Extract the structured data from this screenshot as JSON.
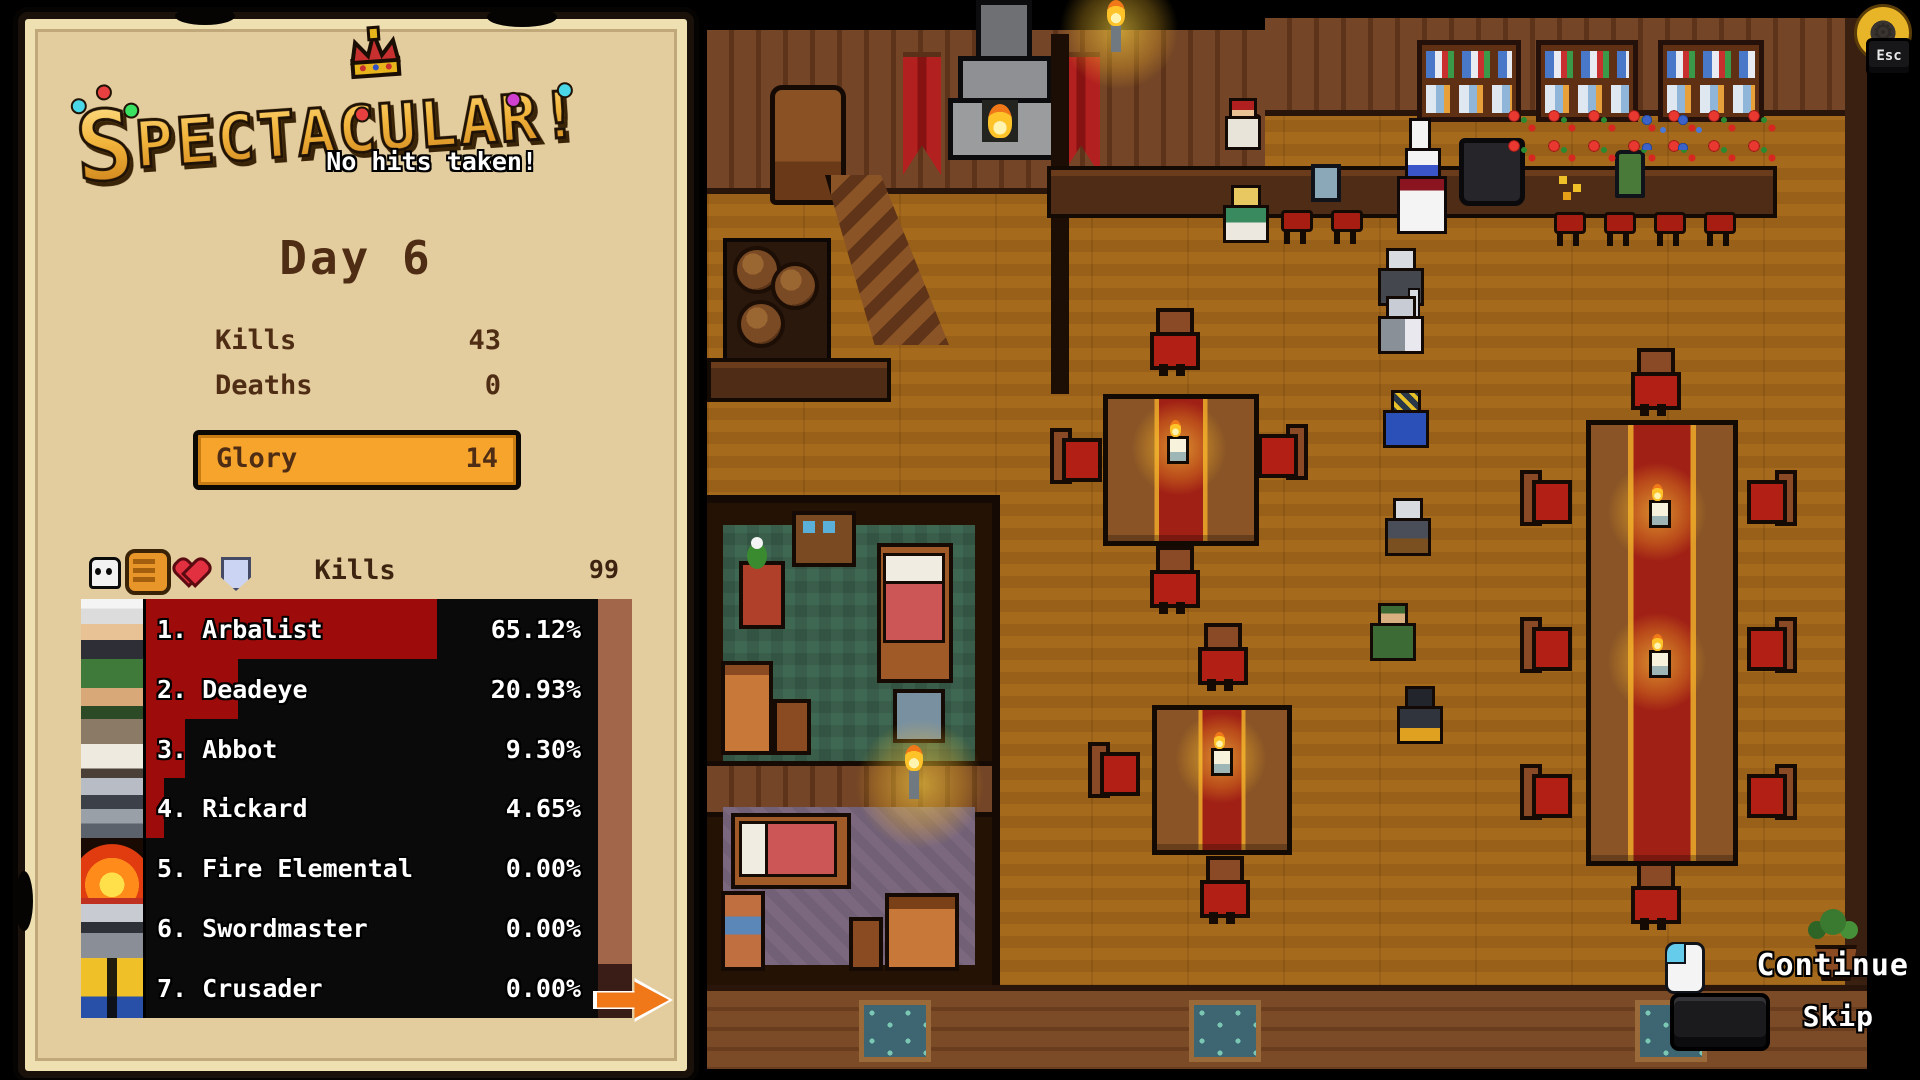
{
  "panel": {
    "logo": {
      "title": "Spectacular!",
      "title_big_letter": "S",
      "title_rest": "PECTACULAR!",
      "subtitle": "No hits taken!",
      "gem_colors": [
        "#4ad8e8",
        "#e84040",
        "#3ae060",
        "#e84040",
        "#d040d0",
        "#4ad8e8"
      ],
      "crown_color": "#e8b41c"
    },
    "day_title": "Day 6",
    "stats": [
      {
        "label": "Kills",
        "value": "43"
      },
      {
        "label": "Deaths",
        "value": "0"
      }
    ],
    "glory": {
      "label": "Glory",
      "value": "14"
    },
    "leaderboard": {
      "metric_label": "Kills",
      "max_value": "99",
      "icons": [
        "skull-icon",
        "fist-icon",
        "heart-icon",
        "shield-icon"
      ],
      "selected_icon": "fist-icon",
      "bar_color": "#9e0b0b",
      "rows": [
        {
          "rank": "1.",
          "name": "Arbalist",
          "pct": "65.12%",
          "value": 65.12,
          "avatar": "arbalist"
        },
        {
          "rank": "2.",
          "name": "Deadeye",
          "pct": "20.93%",
          "value": 20.93,
          "avatar": "deadeye"
        },
        {
          "rank": "3.",
          "name": "Abbot",
          "pct": "9.30%",
          "value": 9.3,
          "avatar": "abbot"
        },
        {
          "rank": "4.",
          "name": "Rickard",
          "pct": "4.65%",
          "value": 4.65,
          "avatar": "rickard"
        },
        {
          "rank": "5.",
          "name": "Fire Elemental",
          "pct": "0.00%",
          "value": 0,
          "avatar": "fire"
        },
        {
          "rank": "6.",
          "name": "Swordmaster",
          "pct": "0.00%",
          "value": 0,
          "avatar": "swordmaster"
        },
        {
          "rank": "7.",
          "name": "Crusader",
          "pct": "0.00%",
          "value": 0,
          "avatar": "crusader"
        }
      ]
    },
    "glory_color": "#f7a42c"
  },
  "hud": {
    "esc_button": {
      "label": "Esc",
      "icon": "gear-icon"
    },
    "continue_button": {
      "label": "Continue",
      "icon": "mouse-left-click-icon"
    },
    "skip_button": {
      "label": "Skip",
      "icon": "spacebar-key-icon"
    }
  }
}
